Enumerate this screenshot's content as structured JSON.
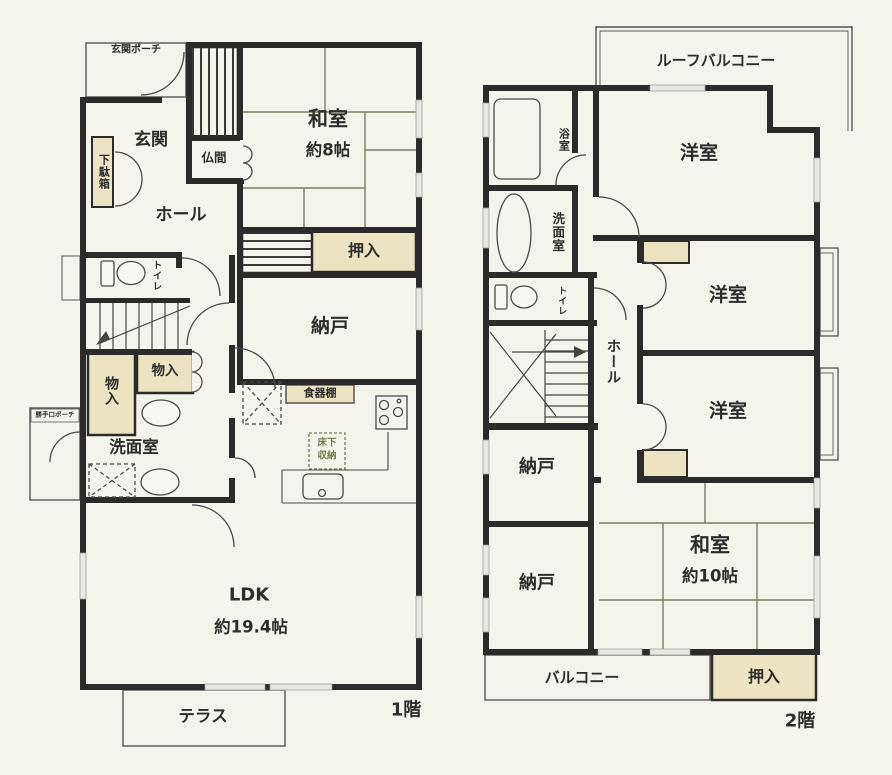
{
  "colors": {
    "wall": "#2b2b2b",
    "paper": "#f5f4ec",
    "closet_fill": "#ebe3c1",
    "tatami_line": "#7a7f5e",
    "label_text": "#2d2d2d",
    "yukashita_text": "#75774b"
  },
  "floor1": {
    "floor_label": "1階",
    "rooms": {
      "genkan_porch": "玄関ポーチ",
      "genkan": "玄関",
      "getabako": "下駄箱",
      "butsuma": "仏間",
      "washitsu": "和室",
      "washitsu_size": "約8帖",
      "hall": "ホール",
      "toilet": "トイレ",
      "oshiire": "押入",
      "nando": "納戸",
      "monoiri_a": "物入",
      "monoiri_b": "物入",
      "senmen": "洗面室",
      "shokkidana": "食器棚",
      "yukashita_line1": "床下",
      "yukashita_line2": "収納",
      "katteguchi_porch": "勝手口ポーチ",
      "ldk": "LDK",
      "ldk_size": "約19.4帖",
      "terrace": "テラス"
    }
  },
  "floor2": {
    "floor_label": "2階",
    "rooms": {
      "roof_balcony": "ルーフバルコニー",
      "bath": "浴室",
      "senmen": "洗面室",
      "yoshitsu_a": "洋室",
      "yoshitsu_b": "洋室",
      "yoshitsu_c": "洋室",
      "toilet": "トイレ",
      "hall": "ホール",
      "nando_a": "納戸",
      "nando_b": "納戸",
      "washitsu": "和室",
      "washitsu_size": "約10帖",
      "oshiire": "押入",
      "balcony": "バルコニー"
    }
  }
}
